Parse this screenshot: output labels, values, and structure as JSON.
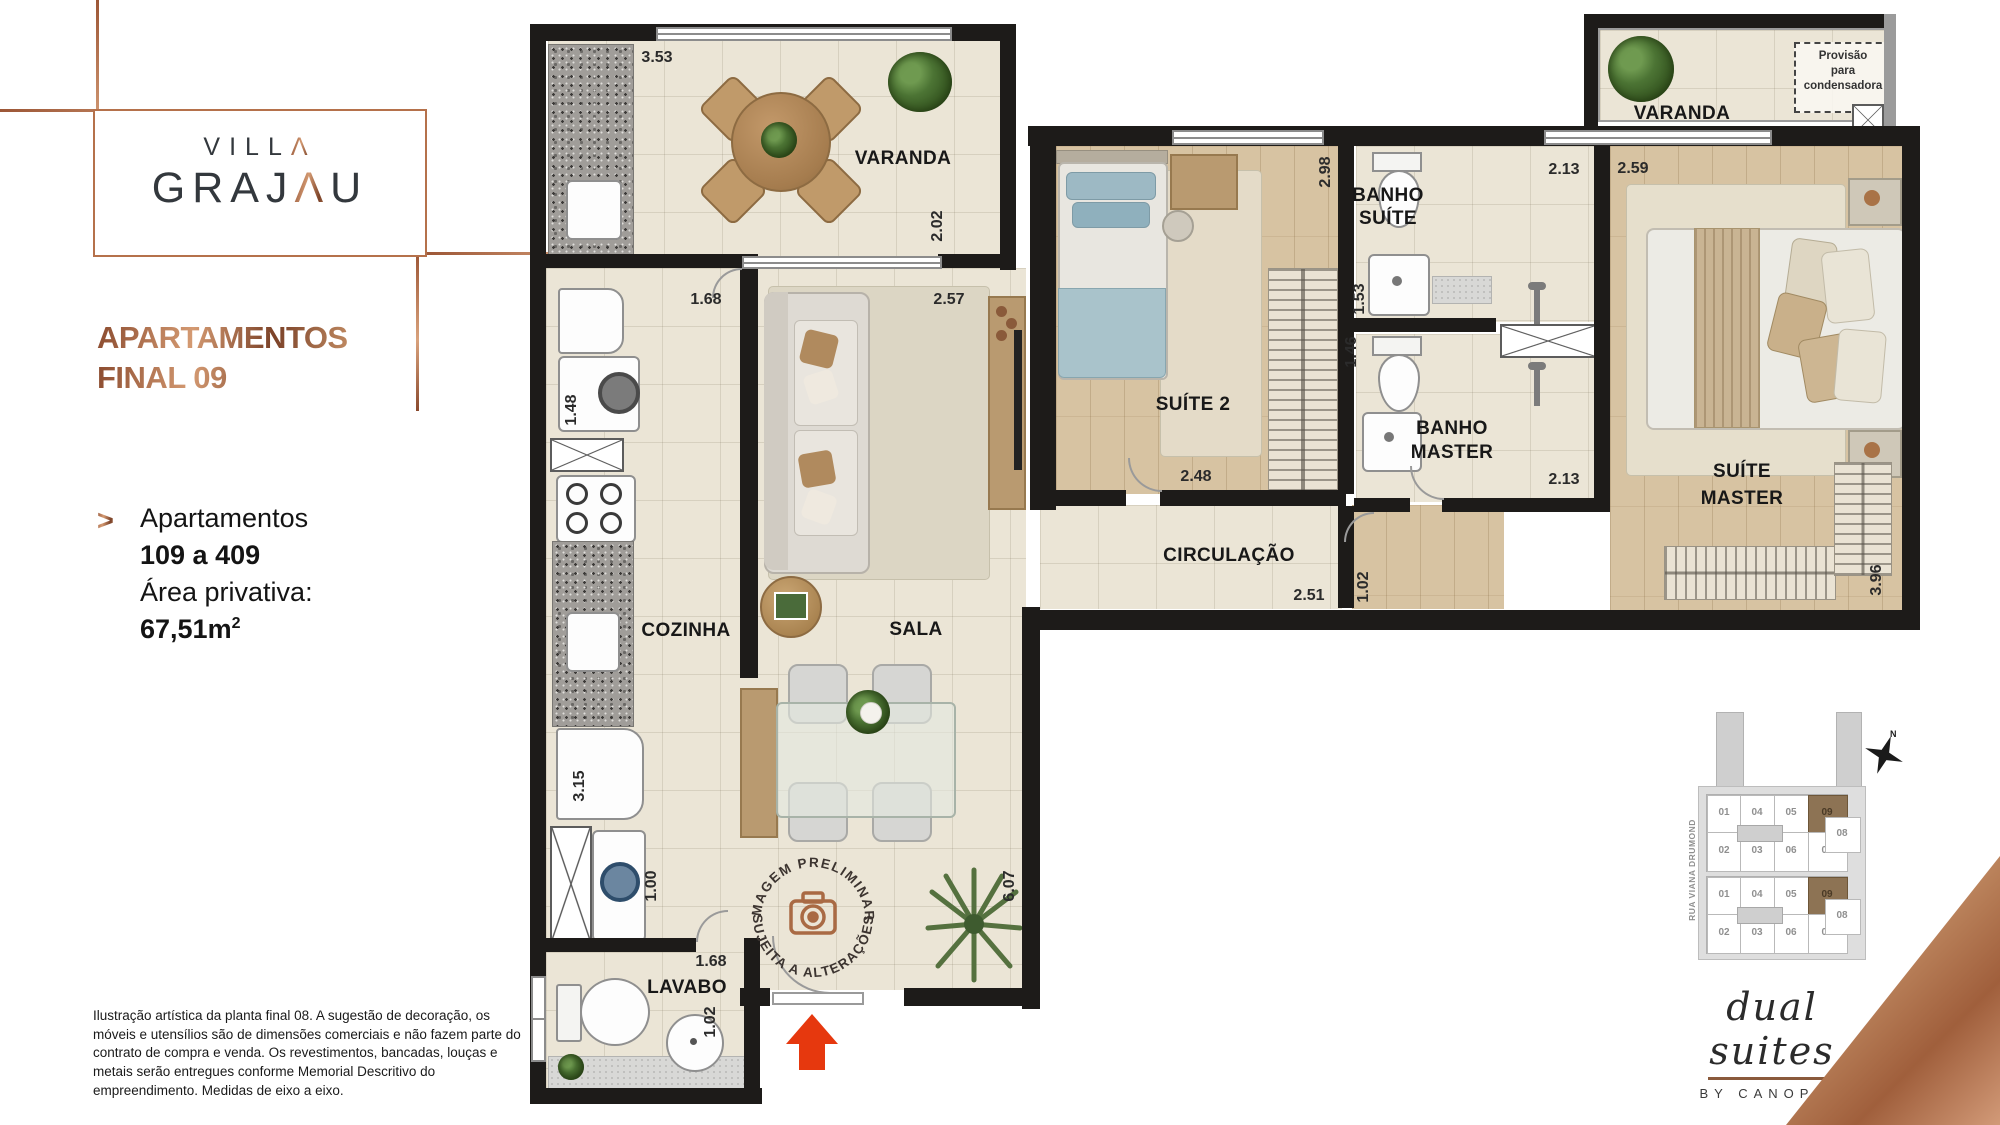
{
  "logo": {
    "line1_pre": "VILL",
    "line1_accent": "Λ",
    "line2_pre": "GRAJ",
    "line2_accent": "Λ",
    "line2_post": "U"
  },
  "title": {
    "line1": "APARTAMENTOS",
    "line2": "FINAL 09"
  },
  "info": {
    "bullet": ">",
    "line1": "Apartamentos",
    "line2": "109 a 409",
    "line3": "Área privativa:",
    "area_base": "67,51m",
    "area_sup": "2"
  },
  "disclaimer": "Ilustração artística da planta final 08. A sugestão de decoração, os móveis e utensílios são de dimensões comerciais e não fazem parte do contrato de compra e venda. Os revestimentos, bancadas, louças e metais serão entregues conforme Memorial Descritivo do empreendimento. Medidas de eixo a eixo.",
  "plan": {
    "labels": {
      "varanda_left": "VARANDA",
      "varanda_right": "VARANDA",
      "cozinha": "COZINHA",
      "sala": "SALA",
      "lavabo": "LAVABO",
      "suite2": "SUÍTE 2",
      "banho_suite_1": "BANHO",
      "banho_suite_2": "SUÍTE",
      "banho_master_1": "BANHO",
      "banho_master_2": "MASTER",
      "suite_master_1": "SUÍTE",
      "suite_master_2": "MASTER",
      "circulacao": "CIRCULAÇÃO",
      "cond_1": "Provisão",
      "cond_2": "para",
      "cond_3": "condensadora"
    },
    "dims": {
      "v353": "3.53",
      "v202": "2.02",
      "v168a": "1.68",
      "v257": "2.57",
      "v148": "1.48",
      "v315": "3.15",
      "v100": "1.00",
      "v607": "6.07",
      "v168b": "1.68",
      "v102b": "1.02",
      "v298": "2.98",
      "v248": "2.48",
      "v153": "1.53",
      "v146": "1.46",
      "v213a": "2.13",
      "v213b": "2.13",
      "v259": "2.59",
      "v396": "3.96",
      "v251": "2.51",
      "v102a": "1.02"
    },
    "stamp": {
      "top": "IMAGEM PRELIMINAR",
      "bottom": "• SUJEITA A ALTERAÇÕES •"
    }
  },
  "keyplan": {
    "street": "RUA VIANA DRUMOND",
    "north": "N",
    "blocks": [
      {
        "r1": [
          "01",
          "04",
          "05",
          "09"
        ],
        "r2": [
          "02",
          "03",
          "06",
          "07"
        ],
        "right": "08"
      },
      {
        "r1": [
          "01",
          "04",
          "05",
          "09"
        ],
        "r2": [
          "02",
          "03",
          "06",
          "07"
        ],
        "right": "08"
      }
    ]
  },
  "brand": {
    "script": "dual suites",
    "sub": "BY CANOPUS"
  },
  "colors": {
    "copper": "#b5714b",
    "arrow": "#e6380e",
    "keyplan_highlight": "#8d7354",
    "wall": "#1d1b19"
  }
}
